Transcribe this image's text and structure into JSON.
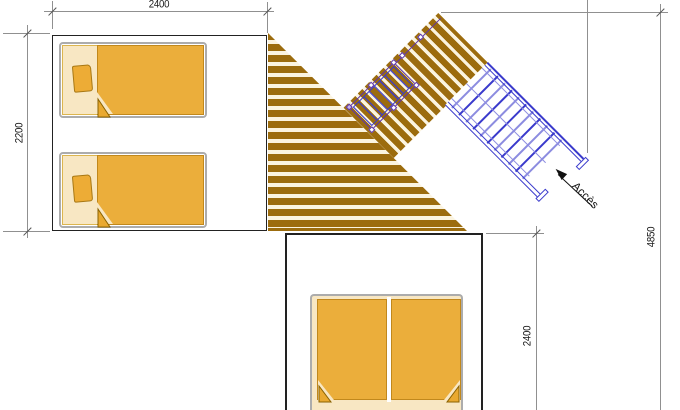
{
  "drawing": {
    "annotations": {
      "dim_top": "2400",
      "dim_left": "2200",
      "dim_right_total": "4850",
      "dim_right_lower": "2400",
      "access_label": "Accès"
    }
  },
  "colors": {
    "deck-brown": "#9C6C0E",
    "deck-gap": "#FBF4E0",
    "bed-orange": "#EBAE3B",
    "bed-cream": "#F8E7C3",
    "bed-edge": "#C1881C",
    "bed-frame": "#ACACAC",
    "stair-blue": "#3A3ACC",
    "stair-blue-light": "#8C8CE0",
    "rail-purple": "#5E35A8",
    "dim-line": "#909090",
    "dim-text": "#1A1A1A",
    "wall": "#222222",
    "arrow-black": "#111111"
  }
}
